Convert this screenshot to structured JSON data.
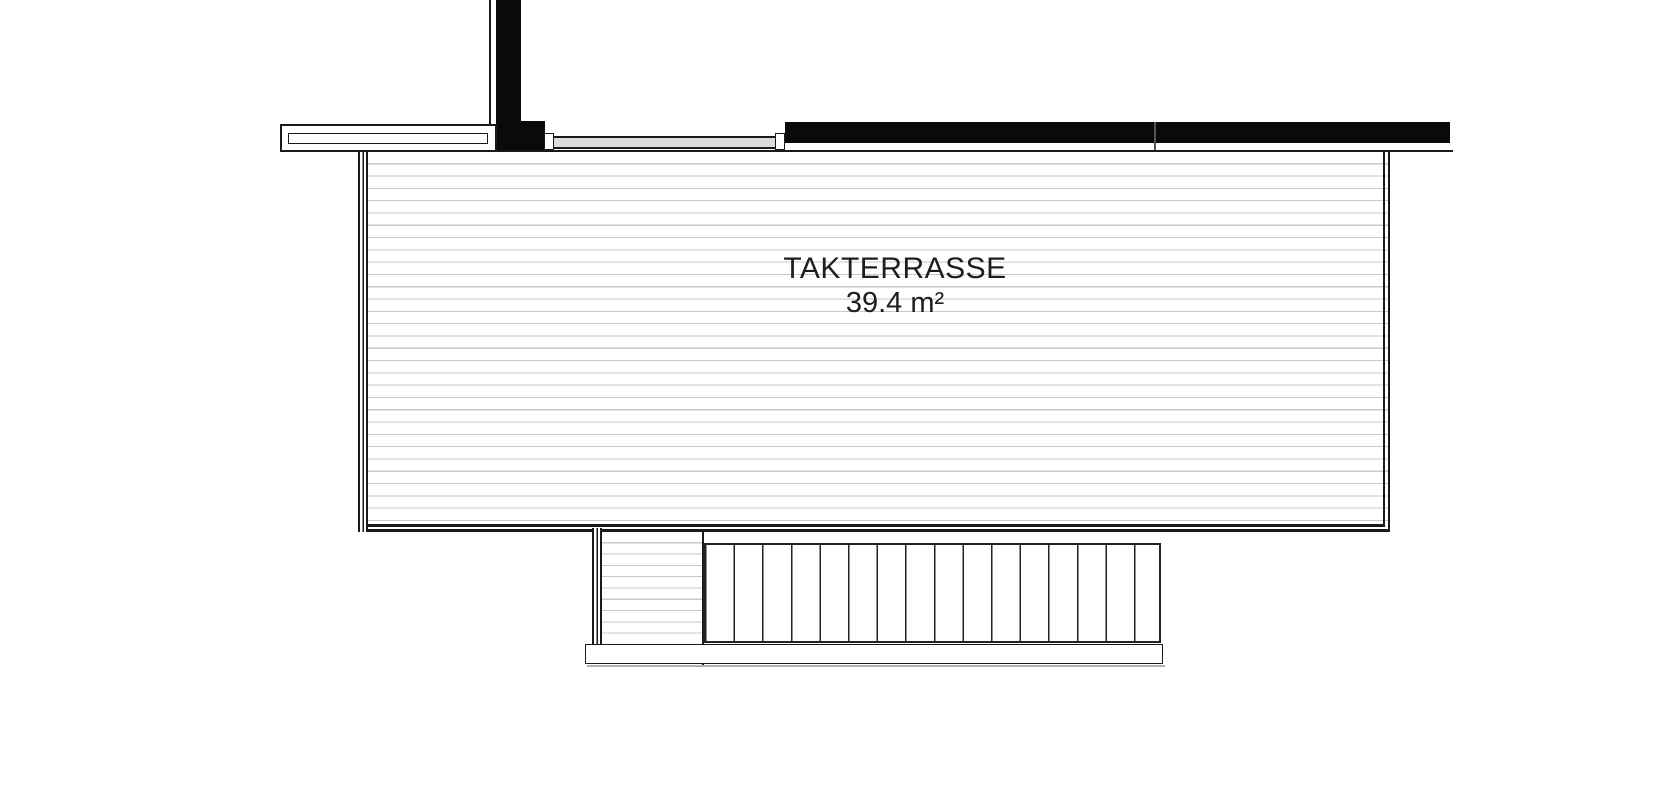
{
  "plan": {
    "room_label": "TAKTERRASSE",
    "room_area": "39.4 m²"
  },
  "colors": {
    "line": "#1a1a1a",
    "wall_fill": "#0a0a0a",
    "deck_hatch": "#c9c9c9",
    "door_fill": "#dcdcdc",
    "background": "#ffffff",
    "text": "#1e1e1e"
  }
}
